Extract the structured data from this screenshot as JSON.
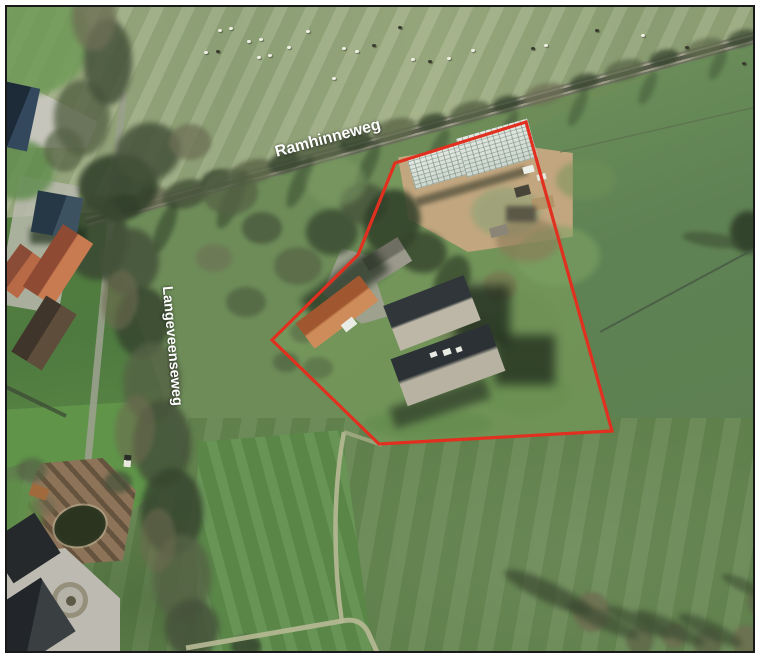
{
  "meta": {
    "title": "Aerial photo map with parcel outline",
    "image_type": "aerial-photo"
  },
  "palette": {
    "field-base": "#6d8c58",
    "outline-red": "#e1301f",
    "label-white": "#ffffff",
    "frame": "#191919",
    "track": "#b7b995",
    "ditch": "#465743"
  },
  "road_labels": [
    {
      "id": "ramhinneweg",
      "text": "Ramhinneweg",
      "x": 328,
      "y": 139,
      "rotation_deg": -15,
      "font_size": 16
    },
    {
      "id": "langeveenseweg",
      "text": "Langeveenseweg",
      "x": 172,
      "y": 346,
      "rotation_deg": 85,
      "font_size": 14.5
    }
  ],
  "parcel_outline": {
    "color": "#e1301f",
    "stroke_width": 3.2,
    "closed": true,
    "points": [
      [
        526,
        122
      ],
      [
        395,
        163
      ],
      [
        358,
        255
      ],
      [
        272,
        340
      ],
      [
        379,
        444
      ],
      [
        612,
        431
      ]
    ]
  },
  "scenery": {
    "blobs": [
      [
        30,
        40,
        120,
        110,
        0,
        "#6f9a57",
        0.85,
        3
      ],
      [
        20,
        170,
        70,
        60,
        0,
        "#5d8a4a",
        0.8,
        3
      ],
      [
        12,
        515,
        60,
        70,
        0,
        "#5f9149",
        0.8,
        3
      ],
      [
        122,
        208,
        42,
        26,
        -15,
        "#45523a",
        0.9,
        2
      ],
      [
        152,
        198,
        34,
        22,
        -15,
        "#6d6f55",
        0.85,
        2
      ],
      [
        186,
        194,
        48,
        28,
        -15,
        "#4a573d",
        0.9,
        2
      ],
      [
        216,
        180,
        30,
        20,
        -15,
        "#37462f",
        0.85,
        2
      ],
      [
        252,
        172,
        46,
        24,
        -15,
        "#5d6849",
        0.85,
        2
      ],
      [
        286,
        162,
        36,
        20,
        -15,
        "#3c4a33",
        0.9,
        2
      ],
      [
        322,
        150,
        52,
        22,
        -15,
        "#556245",
        0.85,
        2
      ],
      [
        356,
        142,
        34,
        18,
        -15,
        "#37462f",
        0.85,
        2
      ],
      [
        394,
        130,
        46,
        22,
        -15,
        "#5d6849",
        0.8,
        2
      ],
      [
        432,
        122,
        30,
        16,
        -15,
        "#3c4a33",
        0.85,
        2
      ],
      [
        470,
        112,
        42,
        20,
        -15,
        "#556245",
        0.8,
        2
      ],
      [
        506,
        104,
        28,
        16,
        -15,
        "#37462f",
        0.8,
        2
      ],
      [
        544,
        94,
        42,
        20,
        -15,
        "#6d6f55",
        0.75,
        2
      ],
      [
        584,
        82,
        30,
        16,
        -15,
        "#3c4a33",
        0.8,
        2
      ],
      [
        624,
        70,
        40,
        20,
        -15,
        "#556245",
        0.75,
        2
      ],
      [
        664,
        58,
        30,
        16,
        -15,
        "#37462f",
        0.8,
        2
      ],
      [
        704,
        48,
        40,
        18,
        -15,
        "#5d6849",
        0.7,
        2
      ],
      [
        742,
        38,
        30,
        16,
        -15,
        "#3c4a33",
        0.75,
        2
      ],
      [
        165,
        228,
        16,
        54,
        22,
        "#2e3d28",
        0.55,
        2
      ],
      [
        232,
        200,
        18,
        62,
        24,
        "#2e3d28",
        0.5,
        2
      ],
      [
        300,
        182,
        16,
        56,
        24,
        "#2e3d28",
        0.45,
        2
      ],
      [
        368,
        166,
        14,
        52,
        24,
        "#2e3d28",
        0.45,
        2
      ],
      [
        438,
        150,
        14,
        46,
        24,
        "#2e3d28",
        0.4,
        2
      ],
      [
        508,
        130,
        12,
        42,
        24,
        "#2e3d28",
        0.4,
        2
      ],
      [
        578,
        108,
        12,
        40,
        24,
        "#2e3d28",
        0.35,
        2
      ],
      [
        648,
        88,
        12,
        36,
        24,
        "#2e3d28",
        0.35,
        2
      ],
      [
        718,
        64,
        12,
        34,
        24,
        "#2e3d28",
        0.35,
        2
      ],
      [
        118,
        186,
        80,
        64,
        0,
        "#2f3e29",
        0.85,
        3
      ],
      [
        96,
        238,
        64,
        84,
        0,
        "#3a4832",
        0.85,
        3
      ],
      [
        148,
        152,
        66,
        58,
        -18,
        "#45523a",
        0.85,
        3
      ],
      [
        82,
        118,
        56,
        76,
        0,
        "#556245",
        0.8,
        3
      ],
      [
        108,
        62,
        48,
        86,
        0,
        "#45523a",
        0.85,
        3
      ],
      [
        94,
        18,
        44,
        66,
        0,
        "#6d6f55",
        0.8,
        3
      ],
      [
        64,
        150,
        40,
        44,
        0,
        "#556245",
        0.7,
        2
      ],
      [
        190,
        142,
        42,
        36,
        0,
        "#6d6f55",
        0.75,
        2
      ],
      [
        130,
        262,
        58,
        68,
        8,
        "#45523a",
        0.85,
        3
      ],
      [
        142,
        322,
        54,
        70,
        4,
        "#37462f",
        0.85,
        3
      ],
      [
        152,
        382,
        58,
        80,
        2,
        "#556245",
        0.8,
        3
      ],
      [
        162,
        444,
        58,
        88,
        0,
        "#45523a",
        0.85,
        3
      ],
      [
        172,
        512,
        62,
        88,
        0,
        "#37462f",
        0.85,
        3
      ],
      [
        182,
        578,
        58,
        88,
        0,
        "#556245",
        0.8,
        3
      ],
      [
        192,
        628,
        54,
        58,
        0,
        "#45523a",
        0.85,
        3
      ],
      [
        120,
        300,
        36,
        60,
        6,
        "#6e6a50",
        0.6,
        2
      ],
      [
        135,
        430,
        40,
        70,
        4,
        "#6e6a50",
        0.55,
        2
      ],
      [
        158,
        540,
        36,
        64,
        0,
        "#6e6a50",
        0.55,
        2
      ],
      [
        230,
        192,
        56,
        46,
        0,
        "#556245",
        0.75,
        2
      ],
      [
        262,
        228,
        40,
        32,
        0,
        "#45523a",
        0.7,
        2
      ],
      [
        298,
        266,
        48,
        38,
        0,
        "#556245",
        0.7,
        2
      ],
      [
        214,
        258,
        36,
        28,
        0,
        "#6d6f55",
        0.6,
        2
      ],
      [
        246,
        302,
        40,
        30,
        0,
        "#45523a",
        0.55,
        2
      ],
      [
        332,
        232,
        52,
        46,
        0,
        "#3b4c33",
        0.85,
        3
      ],
      [
        364,
        204,
        48,
        42,
        0,
        "#45523a",
        0.8,
        3
      ],
      [
        392,
        222,
        56,
        66,
        15,
        "#2f3e28",
        0.85,
        3
      ],
      [
        422,
        252,
        50,
        42,
        8,
        "#35432c",
        0.8,
        3
      ],
      [
        452,
        282,
        34,
        56,
        20,
        "#2f3e28",
        0.7,
        3
      ],
      [
        304,
        332,
        28,
        22,
        0,
        "#556245",
        0.55,
        2
      ],
      [
        286,
        362,
        26,
        20,
        0,
        "#45523a",
        0.5,
        2
      ],
      [
        318,
        368,
        30,
        22,
        0,
        "#4f5f41",
        0.5,
        2
      ],
      [
        506,
        212,
        70,
        50,
        0,
        "#93a377",
        0.7,
        3
      ],
      [
        558,
        256,
        84,
        60,
        0,
        "#7da263",
        0.6,
        3
      ],
      [
        524,
        332,
        72,
        84,
        0,
        "#6f9156",
        0.7,
        3
      ],
      [
        482,
        300,
        42,
        40,
        0,
        "#8b9a6e",
        0.55,
        3
      ],
      [
        336,
        182,
        60,
        48,
        0,
        "#7f9e66",
        0.5,
        3
      ],
      [
        428,
        424,
        130,
        30,
        0,
        "#5f8a4b",
        0.5,
        3
      ],
      [
        524,
        392,
        92,
        50,
        0,
        "#68904f",
        0.55,
        3
      ],
      [
        586,
        180,
        60,
        40,
        0,
        "#6f9156",
        0.5,
        3
      ],
      [
        528,
        240,
        64,
        44,
        0,
        "#8b7a58",
        0.6,
        3
      ],
      [
        500,
        286,
        34,
        30,
        0,
        "#7b6f4e",
        0.55,
        2
      ],
      [
        466,
        330,
        60,
        40,
        0,
        "#70774f",
        0.45,
        3
      ],
      [
        592,
        612,
        36,
        40,
        0,
        "#6e7052",
        0.9,
        2
      ],
      [
        640,
        640,
        28,
        28,
        0,
        "#616a4b",
        0.85,
        2
      ],
      [
        674,
        636,
        24,
        26,
        0,
        "#6e7052",
        0.85,
        2
      ],
      [
        708,
        644,
        28,
        30,
        0,
        "#616a4b",
        0.9,
        2
      ],
      [
        746,
        640,
        28,
        30,
        0,
        "#6e7052",
        0.85,
        2
      ],
      [
        757,
        602,
        20,
        22,
        0,
        "#616a4b",
        0.8,
        2
      ],
      [
        548,
        592,
        96,
        20,
        25,
        "#3b4a31",
        0.7,
        3
      ],
      [
        602,
        620,
        80,
        16,
        25,
        "#3b4a31",
        0.65,
        3
      ],
      [
        638,
        622,
        70,
        14,
        25,
        "#3b4a31",
        0.65,
        3
      ],
      [
        670,
        628,
        76,
        16,
        25,
        "#3b4a31",
        0.65,
        3
      ],
      [
        710,
        630,
        70,
        16,
        25,
        "#3b4a31",
        0.65,
        3
      ],
      [
        745,
        586,
        50,
        12,
        25,
        "#3b4a31",
        0.55,
        2
      ],
      [
        246,
        646,
        30,
        20,
        0,
        "#37462f",
        0.85,
        2
      ],
      [
        748,
        232,
        36,
        42,
        0,
        "#2f3e29",
        0.9,
        3
      ],
      [
        712,
        240,
        60,
        14,
        8,
        "#3b4a31",
        0.55,
        2
      ],
      [
        32,
        470,
        30,
        24,
        0,
        "#556245",
        0.7,
        2
      ],
      [
        118,
        482,
        28,
        22,
        0,
        "#45523a",
        0.7,
        2
      ],
      [
        44,
        506,
        24,
        18,
        0,
        "#6e6a50",
        0.55,
        2
      ]
    ],
    "sheep": [
      [
        218,
        29,
        "w"
      ],
      [
        229,
        27,
        "w"
      ],
      [
        247,
        40,
        "w"
      ],
      [
        259,
        38,
        "w"
      ],
      [
        204,
        51,
        "w"
      ],
      [
        216,
        50,
        "d"
      ],
      [
        257,
        56,
        "w"
      ],
      [
        268,
        54,
        "w"
      ],
      [
        287,
        46,
        "w"
      ],
      [
        306,
        30,
        "w"
      ],
      [
        342,
        47,
        "w"
      ],
      [
        355,
        50,
        "w"
      ],
      [
        372,
        44,
        "d"
      ],
      [
        332,
        77,
        "w"
      ],
      [
        398,
        26,
        "d"
      ],
      [
        411,
        58,
        "w"
      ],
      [
        428,
        60,
        "d"
      ],
      [
        447,
        57,
        "w"
      ],
      [
        471,
        49,
        "w"
      ],
      [
        531,
        47,
        "d"
      ],
      [
        544,
        44,
        "w"
      ],
      [
        595,
        29,
        "d"
      ],
      [
        641,
        34,
        "w"
      ],
      [
        685,
        46,
        "d"
      ],
      [
        742,
        62,
        "d"
      ],
      [
        754,
        108,
        "d"
      ]
    ]
  }
}
